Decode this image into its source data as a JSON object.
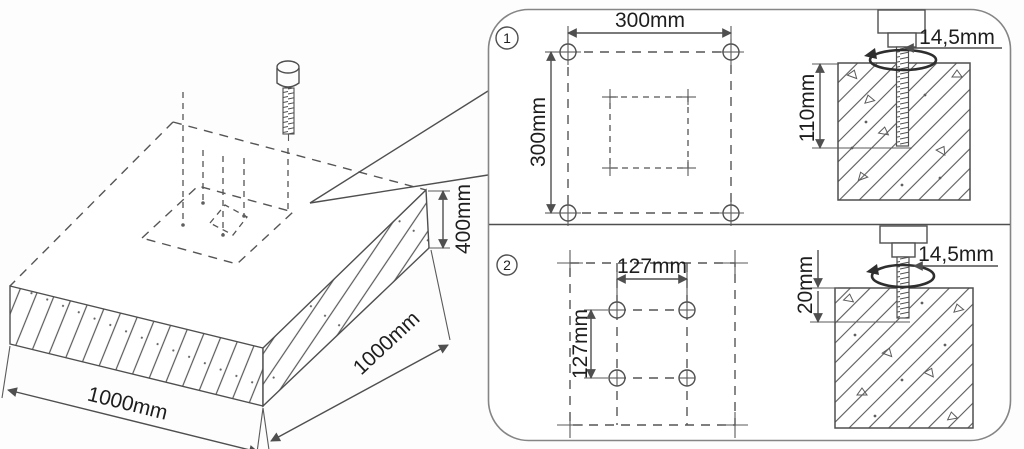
{
  "colors": {
    "line": "#4f4f4f",
    "text": "#1e1e1e",
    "panel_border": "#858585",
    "background": "#fdfdfd"
  },
  "isometric_view": {
    "width_label": "1000mm",
    "depth_label": "1000mm",
    "thickness_label": "400mm"
  },
  "detail_panel": {
    "sections": [
      {
        "badge": "1",
        "pattern_width_label": "300mm",
        "pattern_height_label": "300mm",
        "bolt_diameter_label": "14,5mm",
        "embed_depth_label": "110mm"
      },
      {
        "badge": "2",
        "pattern_width_label": "127mm",
        "pattern_height_label": "127mm",
        "bolt_diameter_label": "14,5mm",
        "embed_depth_label": "20mm"
      }
    ]
  }
}
